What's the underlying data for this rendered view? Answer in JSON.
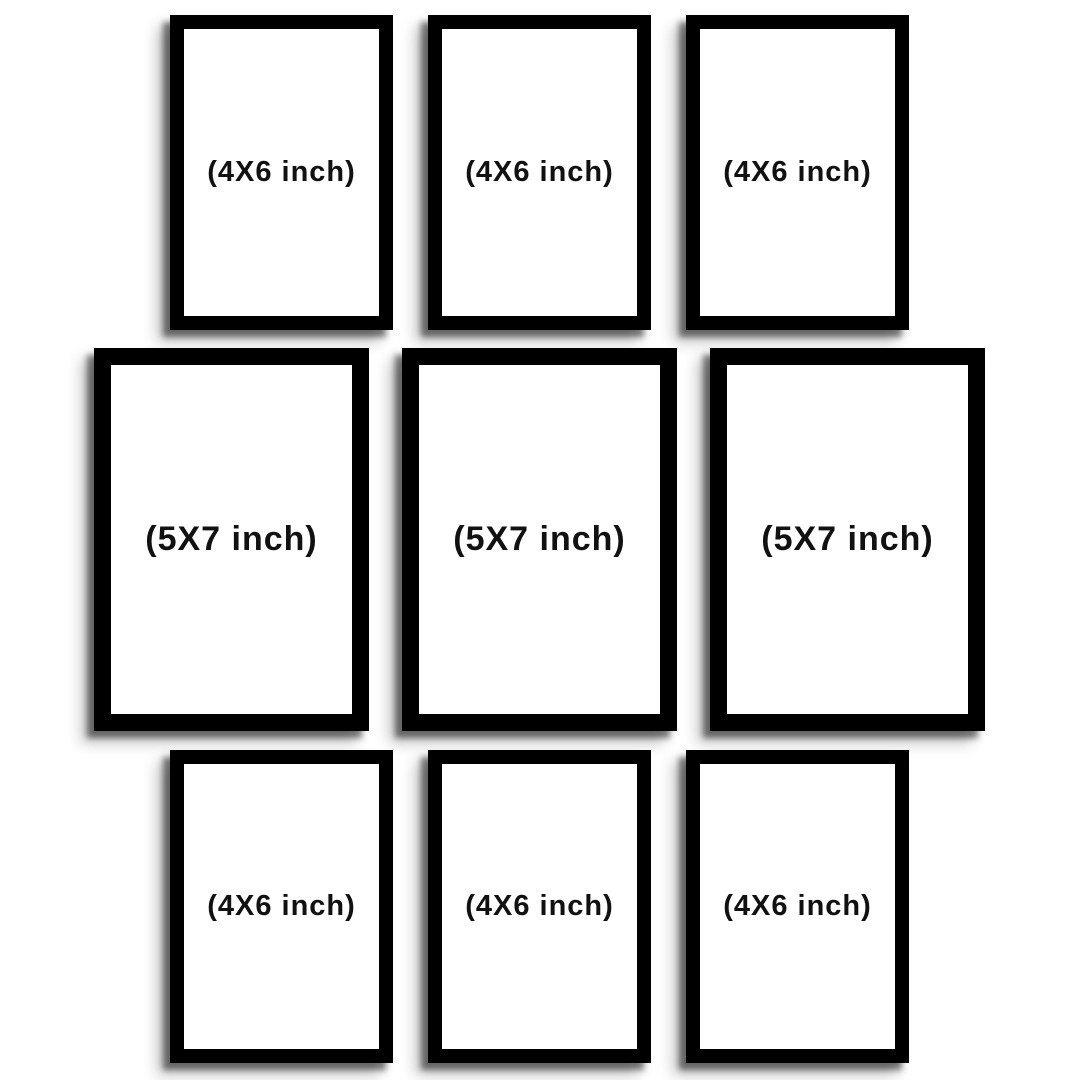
{
  "title": "9-piece photo frame set size diagram",
  "colors": {
    "background": "#ffffff",
    "frame": "#000000",
    "mat": "#ffffff",
    "label_text": "#111111"
  },
  "frames": [
    {
      "position": "top-left",
      "size": "4X6 inch",
      "label": "(4X6 inch)"
    },
    {
      "position": "top-center",
      "size": "4X6 inch",
      "label": "(4X6 inch)"
    },
    {
      "position": "top-right",
      "size": "4X6 inch",
      "label": "(4X6 inch)"
    },
    {
      "position": "middle-left",
      "size": "5X7 inch",
      "label": "(5X7 inch)"
    },
    {
      "position": "middle-center",
      "size": "5X7 inch",
      "label": "(5X7 inch)"
    },
    {
      "position": "middle-right",
      "size": "5X7 inch",
      "label": "(5X7 inch)"
    },
    {
      "position": "bottom-left",
      "size": "4X6 inch",
      "label": "(4X6 inch)"
    },
    {
      "position": "bottom-center",
      "size": "4X6 inch",
      "label": "(4X6 inch)"
    },
    {
      "position": "bottom-right",
      "size": "4X6 inch",
      "label": "(4X6 inch)"
    }
  ]
}
